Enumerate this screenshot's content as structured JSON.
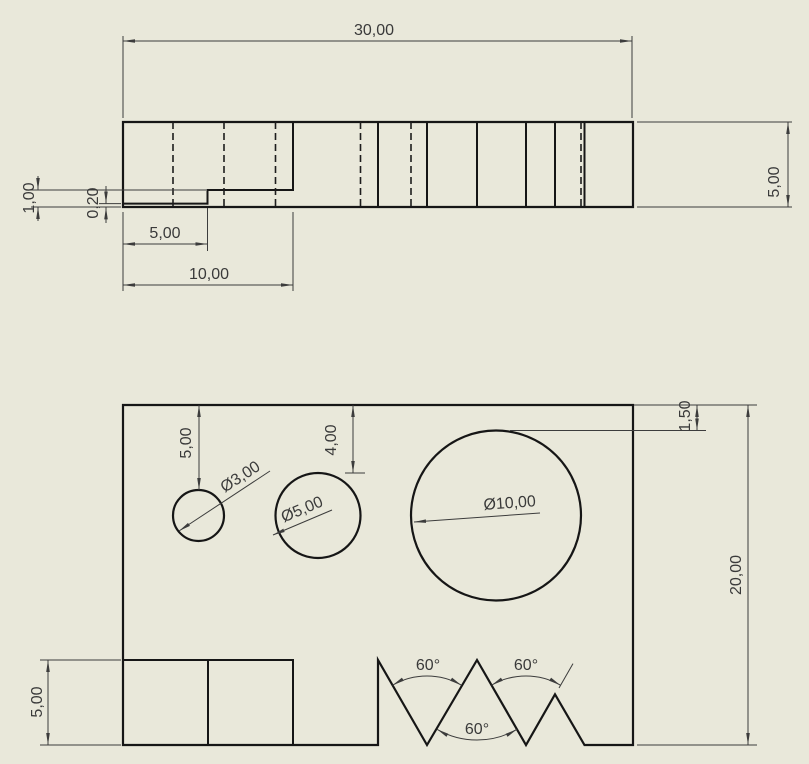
{
  "colors": {
    "background": "#e9e8da",
    "part_line": "#161616",
    "dimension_line": "#3c3c3c",
    "text": "#3a3a3a"
  },
  "side_view": {
    "labels": {
      "overall_width": "30,00",
      "thickness": "5,00",
      "pocket_depth": "1,00",
      "lip_depth": "0,20",
      "lip_width": "5,00",
      "pocket_width": "10,00"
    }
  },
  "front_view": {
    "labels": {
      "hole_small_offset": "5,00",
      "hole_medium_offset": "4,00",
      "hole_small_diameter": "Ø3,00",
      "hole_medium_diameter": "Ø5,00",
      "hole_large_diameter": "Ø10,00",
      "hole_large_offset": "1,50",
      "overall_height": "20,00",
      "recess_height": "5,00",
      "notch_angle_left": "60°",
      "notch_angle_right": "60°",
      "notch_angle_bottom": "60°"
    }
  }
}
